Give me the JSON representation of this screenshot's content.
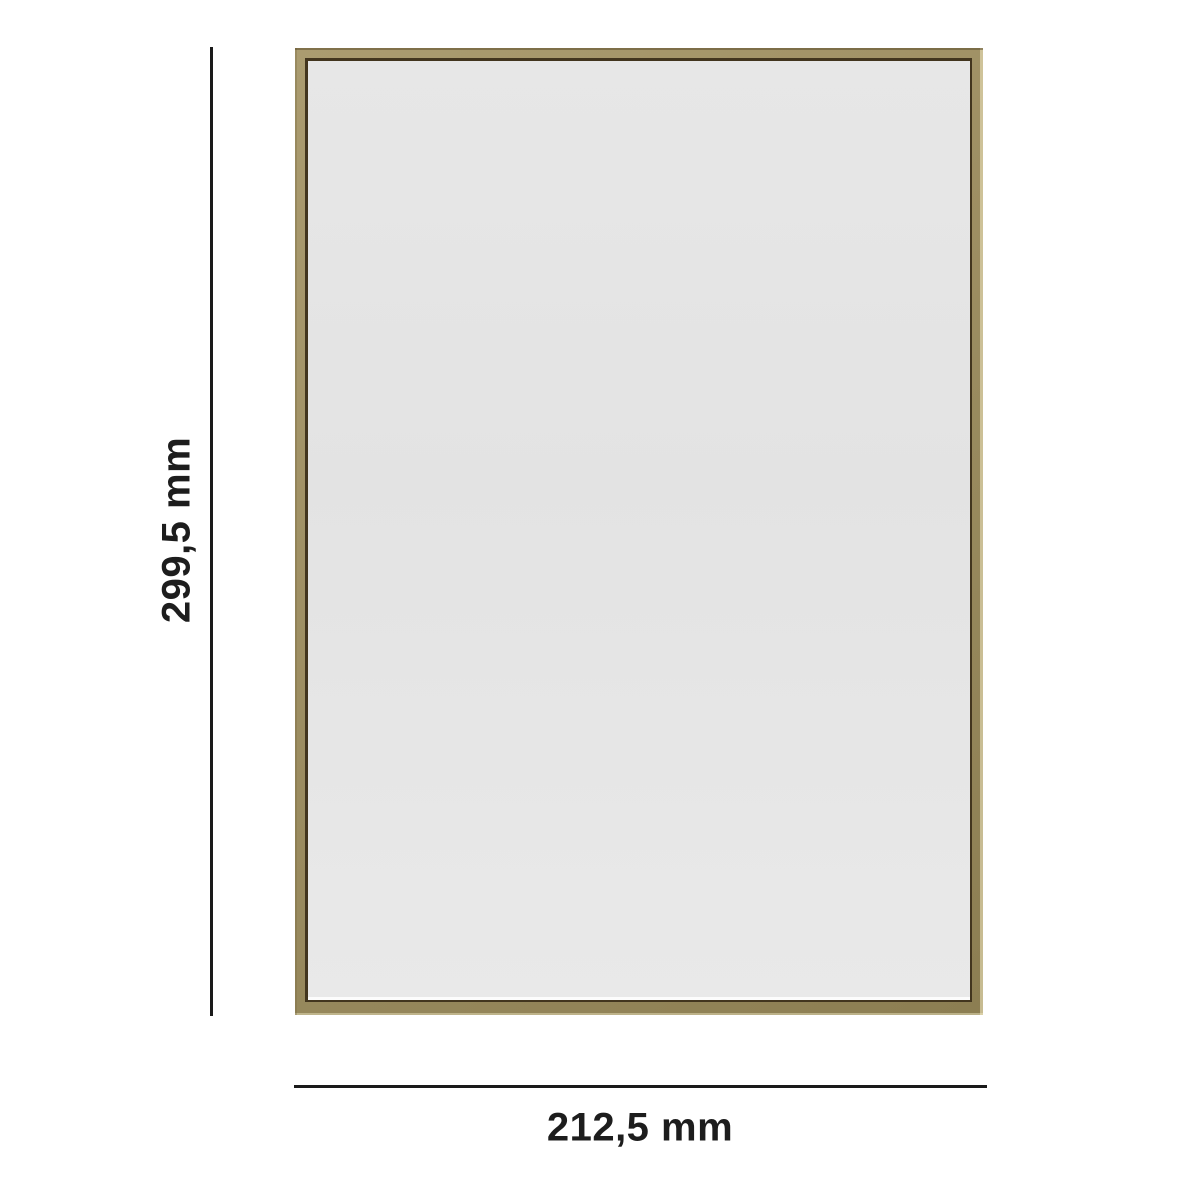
{
  "diagram": {
    "height_label": "299,5 mm",
    "width_label": "212,5 mm",
    "colors": {
      "background": "#ffffff",
      "dimension_line": "#1a1a1a",
      "label_text": "#1d1d1d",
      "frame_gold": "#9d8e62",
      "frame_gold_light": "#ab9c70",
      "frame_gold_dark": "#8c7e52",
      "frame_inner_shadow": "#42351e",
      "mat": "#e3e3e3"
    }
  }
}
